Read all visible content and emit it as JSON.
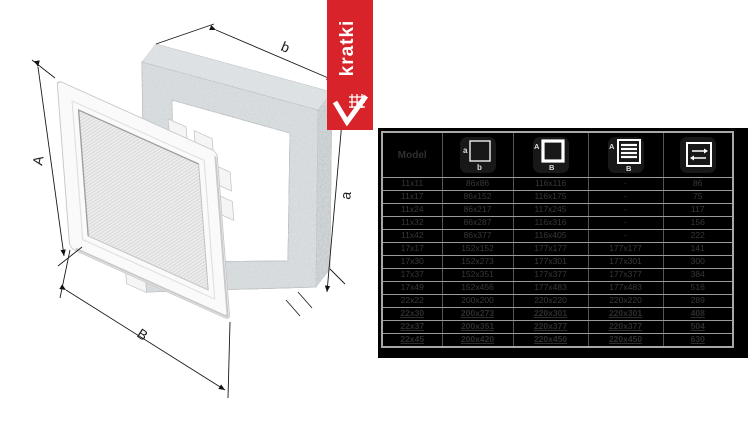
{
  "brand": {
    "name": "kratki",
    "banner_color": "#d8232a"
  },
  "drawing": {
    "dim_labels": {
      "grille_height": "A",
      "grille_width": "B",
      "frame_height": "a",
      "frame_width": "b"
    }
  },
  "table": {
    "bg": "#000000",
    "text_color": "#383838",
    "grid_color": "#9a9a9a",
    "header": {
      "model": "Model",
      "columns": [
        {
          "icon": "mounting-hole-dimensions-icon",
          "label_left": "a",
          "label_bottom": "b"
        },
        {
          "icon": "external-dimensions-icon",
          "label_left": "A",
          "label_bottom": "B"
        },
        {
          "icon": "louvre-grille-dimensions-icon",
          "label_left": "A",
          "label_bottom": "B"
        },
        {
          "icon": "airflow-area-icon"
        }
      ]
    },
    "rows": [
      {
        "model": "11x11",
        "hole": "86x86",
        "external": "116x116",
        "grille": "-",
        "area": "86",
        "hl": false
      },
      {
        "model": "11x17",
        "hole": "86x152",
        "external": "116x175",
        "grille": "-",
        "area": "75",
        "hl": false
      },
      {
        "model": "11x24",
        "hole": "86x217",
        "external": "117x245",
        "grille": "-",
        "area": "117",
        "hl": false
      },
      {
        "model": "11x32",
        "hole": "86x287",
        "external": "116x316",
        "grille": "-",
        "area": "156",
        "hl": false
      },
      {
        "model": "11x42",
        "hole": "86x377",
        "external": "116x405",
        "grille": "-",
        "area": "222",
        "hl": false
      },
      {
        "model": "17x17",
        "hole": "152x152",
        "external": "177x177",
        "grille": "177x177",
        "area": "141",
        "hl": false
      },
      {
        "model": "17x30",
        "hole": "152x273",
        "external": "177x301",
        "grille": "177x301",
        "area": "300",
        "hl": false
      },
      {
        "model": "17x37",
        "hole": "152x351",
        "external": "177x377",
        "grille": "177x377",
        "area": "384",
        "hl": false
      },
      {
        "model": "17x49",
        "hole": "152x456",
        "external": "177x483",
        "grille": "177x483",
        "area": "516",
        "hl": false
      },
      {
        "model": "22x22",
        "hole": "200x200",
        "external": "220x220",
        "grille": "220x220",
        "area": "289",
        "hl": false
      },
      {
        "model": "22x30",
        "hole": "200x273",
        "external": "220x301",
        "grille": "220x301",
        "area": "408",
        "hl": true
      },
      {
        "model": "22x37",
        "hole": "200x351",
        "external": "220x377",
        "grille": "220x377",
        "area": "504",
        "hl": true
      },
      {
        "model": "22x45",
        "hole": "200x420",
        "external": "220x450",
        "grille": "220x450",
        "area": "630",
        "hl": true
      }
    ]
  }
}
